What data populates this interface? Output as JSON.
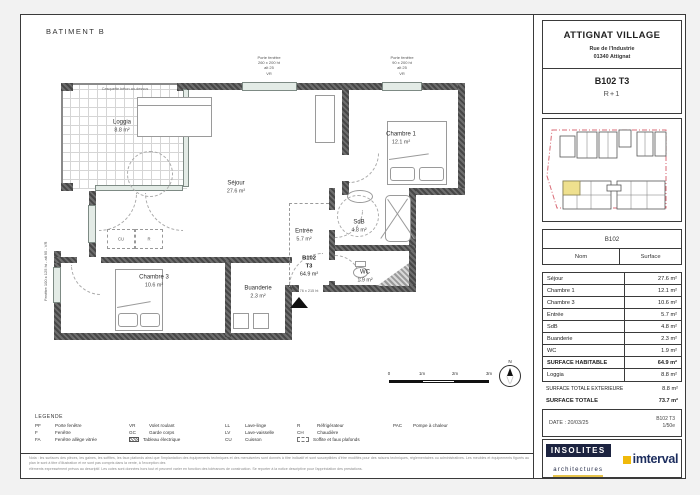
{
  "colors": {
    "accent_red": "#d96a75",
    "highlight_yellow": "#efe08e",
    "logo_navy": "#1c2340",
    "logo_yellow": "#f0b90b",
    "wall_gray": "#555555"
  },
  "batiment_label": "BATIMENT B",
  "title_block": {
    "project": "ATTIGNAT VILLAGE",
    "address1": "Rue de l'Industrie",
    "address2": "01340 Attignat",
    "unit": "B102 T3",
    "level": "R+1"
  },
  "plan": {
    "rooms": [
      {
        "name": "Loggia",
        "area": "8.8 m²"
      },
      {
        "name": "Séjour",
        "area": "27.6 m²"
      },
      {
        "name": "Chambre 1",
        "area": "12.1 m²"
      },
      {
        "name": "SdB",
        "area": "4.8 m²"
      },
      {
        "name": "Entrée",
        "area": "5.7 m²"
      },
      {
        "name": "WC",
        "area": "1.9 m²"
      },
      {
        "name": "Chambre 3",
        "area": "10.6 m²"
      },
      {
        "name": "Buanderie",
        "area": "2.3 m²"
      }
    ],
    "unit_tag": {
      "line1": "B102",
      "line2": "T3",
      "area": "64.9 m²",
      "door_dim": "76 x 215 ht"
    },
    "annotations": {
      "top_left": "Porte fenêtre\n260 x 200 ht\nalt 25\nVR",
      "top_right": "Porte fenêtre\n90 x 200 ht\nalt 25\nVR",
      "left_side": "Fenêtre 100 x 125 ht - alt 95 - VR",
      "loggia_top": "Casquette béton au-dessus",
      "kitchen": [
        "CU",
        "R"
      ]
    }
  },
  "scale_bar": {
    "ticks": [
      "0",
      "1m",
      "2m",
      "3m"
    ],
    "north": "N"
  },
  "legend": {
    "title": "LEGENDE",
    "items": [
      {
        "abbr": "PF",
        "label": "Porte fenêtre"
      },
      {
        "abbr": "F",
        "label": "Fenêtre"
      },
      {
        "abbr": "FA",
        "label": "Fenêtre allège vitrée"
      },
      {
        "abbr": "VR",
        "label": "Volet roulant"
      },
      {
        "abbr": "GC",
        "label": "Garde corps"
      },
      {
        "abbr": "",
        "label": "Tableau électrique"
      },
      {
        "abbr": "LL",
        "label": "Lave-linge"
      },
      {
        "abbr": "LV",
        "label": "Lave-vaisselle"
      },
      {
        "abbr": "CU",
        "label": "Cuisson"
      },
      {
        "abbr": "R",
        "label": "Réfrigérateur"
      },
      {
        "abbr": "CH",
        "label": "Chaudière"
      },
      {
        "abbr": "",
        "label": "Soffite et faux plafonds"
      },
      {
        "abbr": "PAC",
        "label": "Pompe à chaleur"
      }
    ]
  },
  "table": {
    "unit_header": "B102",
    "col_name": "Nom",
    "col_surface": "Surface",
    "rows": [
      {
        "name": "Séjour",
        "value": "27.6 m²"
      },
      {
        "name": "Chambre 1",
        "value": "12.1 m²"
      },
      {
        "name": "Chambre 3",
        "value": "10.6 m²"
      },
      {
        "name": "Entrée",
        "value": "5.7 m²"
      },
      {
        "name": "SdB",
        "value": "4.8 m²"
      },
      {
        "name": "Buanderie",
        "value": "2.3 m²"
      },
      {
        "name": "WC",
        "value": "1.9 m²"
      },
      {
        "name": "SURFACE HABITABLE",
        "value": "64.9 m²"
      },
      {
        "name": "Loggia",
        "value": "8.8 m²"
      }
    ],
    "totals": [
      {
        "name": "SURFACE TOTALE EXTERIEURE",
        "value": "8.8 m²"
      },
      {
        "name": "SURFACE TOTALE",
        "value": "73.7 m²"
      }
    ]
  },
  "footer": {
    "date": "DATE : 20/03/25",
    "ref_line1": "B102 T3",
    "ref_line2": "1/50e"
  },
  "logos": {
    "architect": "INSOLITES",
    "architect_sub": "architectures",
    "developer": "imterval"
  },
  "fine_print": {
    "line1": "Nota : les surfaces des pièces, les gaines, les soffites, les faux plafonds ainsi que l'implantation des équipements techniques et des menuiseries sont donnés à titre indicatif et sont susceptibles d'être modifiés pour des raisons techniques, réglementaires ou administratives. Les meubles et équipements figurés au plan le sont à titre d'illustration et ne sont pas compris dans la vente, à l'exception des",
    "line2": "éléments expressément prévus au descriptif. Les cotes sont données hors tout et peuvent varier en fonction des tolérances de construction. Se reporter à la notice descriptive pour l'appréciation des prestations."
  }
}
